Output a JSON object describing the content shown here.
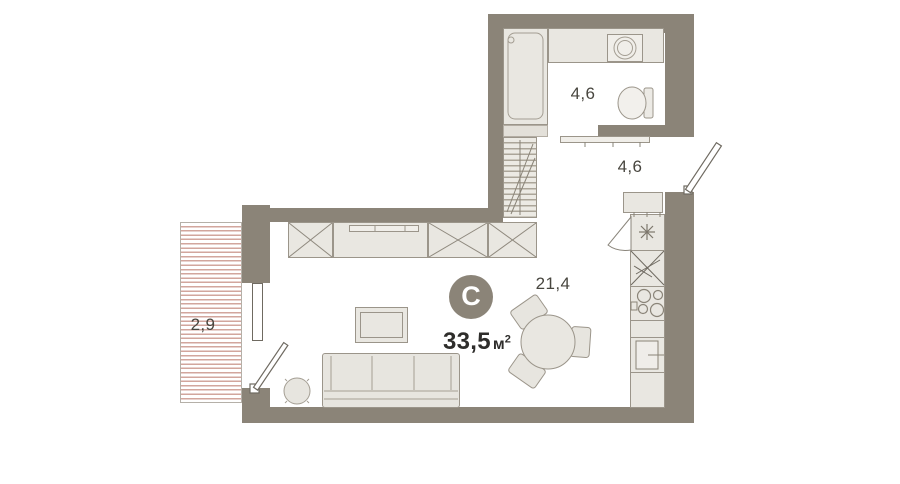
{
  "unit": {
    "badge_letter": "С",
    "total_area": "33,5",
    "area_unit": "м",
    "area_superscript": "2"
  },
  "rooms": {
    "bathroom": {
      "area": "4,6"
    },
    "hallway": {
      "area": "4,6"
    },
    "living_kitchen": {
      "area": "21,4"
    },
    "balcony": {
      "area": "2,9"
    }
  },
  "colors": {
    "wall": "#8b8478",
    "fixture_fill": "#e9e7e1",
    "fixture_stroke": "#9b958a",
    "door_stroke": "#6f6a61",
    "balcony_hatch": "#d2a69d",
    "label_text": "#48463f",
    "total_text": "#2e2d2b",
    "badge_fill": "#8b8478",
    "badge_text": "#ffffff",
    "background": "#ffffff"
  }
}
